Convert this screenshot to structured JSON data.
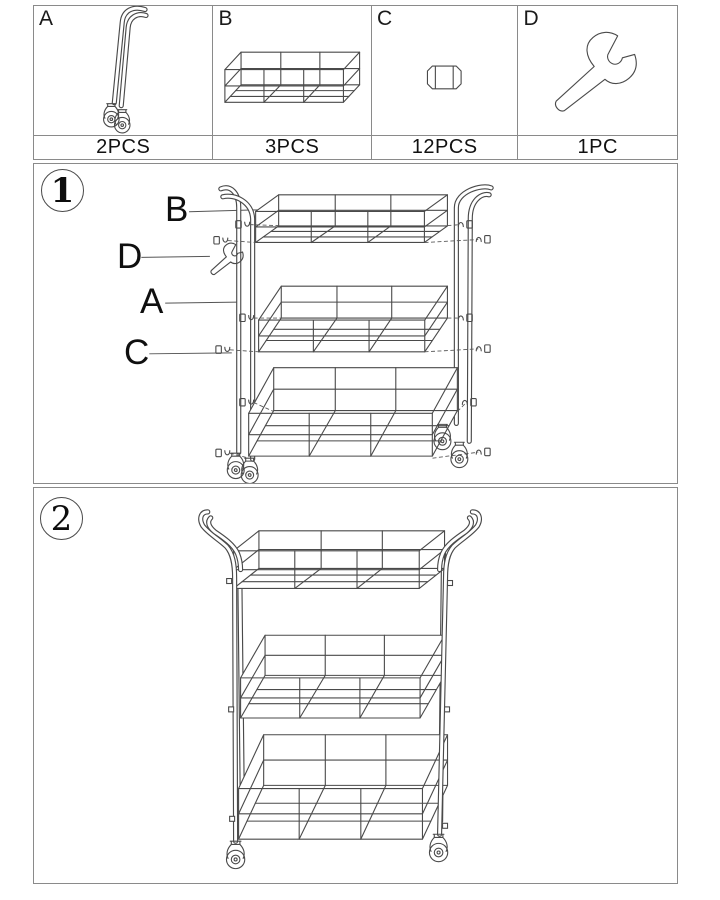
{
  "parts_table": {
    "parts": [
      {
        "letter": "A",
        "count": "2PCS"
      },
      {
        "letter": "B",
        "count": "3PCS"
      },
      {
        "letter": "C",
        "count": "12PCS"
      },
      {
        "letter": "D",
        "count": "1PC"
      }
    ]
  },
  "steps": [
    {
      "number": "1",
      "callouts": [
        "B",
        "D",
        "A",
        "C"
      ]
    },
    {
      "number": "2"
    }
  ]
}
